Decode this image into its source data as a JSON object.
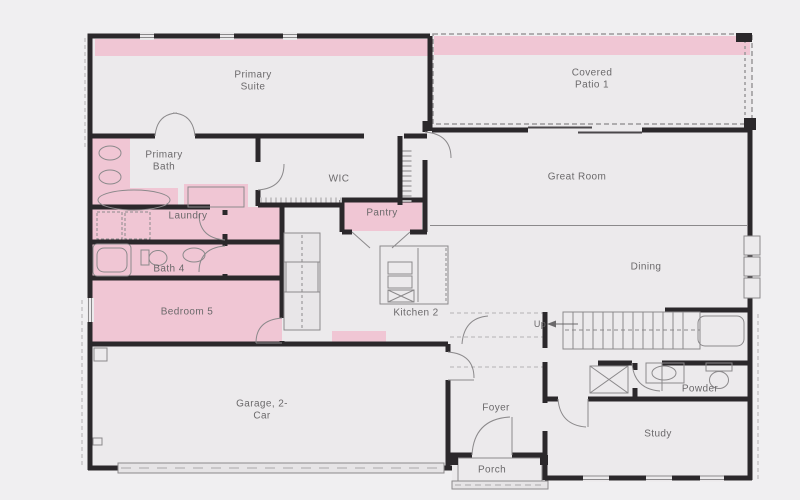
{
  "plan": {
    "type": "floor-plan",
    "floor": "first-floor",
    "rooms": [
      {
        "id": "primary-suite",
        "label": "Primary Suite",
        "highlighted": false
      },
      {
        "id": "covered-patio-1",
        "label": "Covered Patio 1",
        "highlighted": false
      },
      {
        "id": "primary-bath",
        "label": "Primary Bath",
        "highlighted": true
      },
      {
        "id": "wic",
        "label": "WIC",
        "highlighted": false
      },
      {
        "id": "great-room",
        "label": "Great Room",
        "highlighted": false
      },
      {
        "id": "laundry",
        "label": "Laundry",
        "highlighted": true
      },
      {
        "id": "pantry",
        "label": "Pantry",
        "highlighted": true
      },
      {
        "id": "bath-4",
        "label": "Bath 4",
        "highlighted": true
      },
      {
        "id": "dining",
        "label": "Dining",
        "highlighted": false
      },
      {
        "id": "bedroom-5",
        "label": "Bedroom 5",
        "highlighted": true
      },
      {
        "id": "kitchen-2",
        "label": "Kitchen 2",
        "highlighted": false
      },
      {
        "id": "garage-2-car",
        "label": "Garage, 2-Car",
        "highlighted": false
      },
      {
        "id": "foyer",
        "label": "Foyer",
        "highlighted": false
      },
      {
        "id": "powder",
        "label": "Powder",
        "highlighted": false
      },
      {
        "id": "study",
        "label": "Study",
        "highlighted": false
      },
      {
        "id": "porch",
        "label": "Porch",
        "highlighted": false
      },
      {
        "id": "stairs",
        "label": "Up",
        "highlighted": false
      }
    ],
    "colors": {
      "background": "#f0eff1",
      "floor": "#eceaec",
      "highlight_pink": "#f0c6d4",
      "wall": "#2b282b",
      "fixture_line": "#8b898b",
      "label_text": "#6b696b"
    }
  }
}
